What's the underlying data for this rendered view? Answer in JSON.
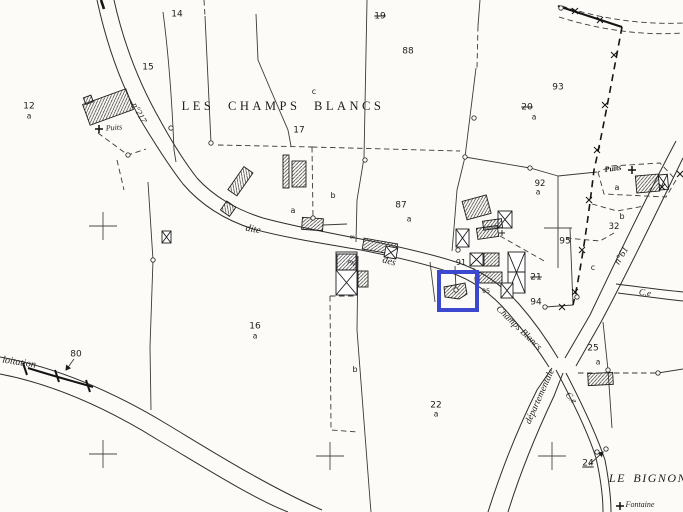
{
  "map": {
    "type": "cadastral-plan",
    "place_name_main": "LES CHAMPS BLANCS",
    "place_name_secondary": "LE BIGNON",
    "background": "#fcfbf7",
    "ink": "#222222",
    "highlight": {
      "x": 437,
      "y": 270,
      "w": 34,
      "h": 34,
      "color": "#3c49cf",
      "stroke": 4
    },
    "labels": [
      {
        "name": "place-les-champs-blancs",
        "t": "LES CHAMPS BLANCS",
        "x": 283,
        "y": 106,
        "fs": 12.5,
        "cls": "place",
        "ls": 3.5
      },
      {
        "name": "place-le-bignon",
        "t": "LE BIGNON",
        "x": 648,
        "y": 478,
        "fs": 12,
        "cls": "place italic",
        "ls": 1.5
      },
      {
        "name": "parcel-number-14",
        "t": "14",
        "x": 177,
        "y": 15,
        "fs": 9,
        "cls": "num"
      },
      {
        "name": "parcel-number-15",
        "t": "15",
        "x": 148,
        "y": 68,
        "fs": 9,
        "cls": "num"
      },
      {
        "name": "parcel-number-12",
        "t": "12",
        "x": 29,
        "y": 107,
        "fs": 9,
        "cls": "num"
      },
      {
        "name": "parcel-letter-12a",
        "t": "a",
        "x": 29,
        "y": 116,
        "fs": 7.5,
        "cls": "num"
      },
      {
        "name": "parcel-number-19-struck",
        "t": "19",
        "x": 380,
        "y": 17,
        "fs": 9,
        "cls": "num strike"
      },
      {
        "name": "parcel-number-88",
        "t": "88",
        "x": 408,
        "y": 52,
        "fs": 9,
        "cls": "num"
      },
      {
        "name": "parcel-number-93",
        "t": "93",
        "x": 558,
        "y": 88,
        "fs": 9,
        "cls": "num"
      },
      {
        "name": "parcel-number-20-struck",
        "t": "20",
        "x": 527,
        "y": 108,
        "fs": 9,
        "cls": "num strike"
      },
      {
        "name": "parcel-letter-20a",
        "t": "a",
        "x": 534,
        "y": 117,
        "fs": 7.5,
        "cls": "num"
      },
      {
        "name": "parcel-number-17",
        "t": "17",
        "x": 299,
        "y": 131,
        "fs": 9,
        "cls": "num"
      },
      {
        "name": "parcel-letter-c-top",
        "t": "c",
        "x": 314,
        "y": 92,
        "fs": 8,
        "cls": "num"
      },
      {
        "name": "parcel-number-87",
        "t": "87",
        "x": 401,
        "y": 206,
        "fs": 9,
        "cls": "num"
      },
      {
        "name": "parcel-letter-87a",
        "t": "a",
        "x": 409,
        "y": 219,
        "fs": 7.5,
        "cls": "num"
      },
      {
        "name": "parcel-letter-b-17",
        "t": "b",
        "x": 333,
        "y": 196,
        "fs": 8,
        "cls": "num"
      },
      {
        "name": "parcel-letter-a-17",
        "t": "a",
        "x": 293,
        "y": 211,
        "fs": 8,
        "cls": "num"
      },
      {
        "name": "parcel-number-92",
        "t": "92",
        "x": 540,
        "y": 184,
        "fs": 8.5,
        "cls": "num"
      },
      {
        "name": "parcel-letter-92a",
        "t": "a",
        "x": 538,
        "y": 192,
        "fs": 7.5,
        "cls": "num"
      },
      {
        "name": "parcel-number-95",
        "t": "95",
        "x": 565,
        "y": 242,
        "fs": 9,
        "cls": "num"
      },
      {
        "name": "parcel-number-91",
        "t": "91",
        "x": 461,
        "y": 263,
        "fs": 8,
        "cls": "num"
      },
      {
        "name": "parcel-number-21-struck",
        "t": "21",
        "x": 536,
        "y": 278,
        "fs": 9,
        "cls": "num strike"
      },
      {
        "name": "parcel-number-94",
        "t": "94",
        "x": 536,
        "y": 303,
        "fs": 9,
        "cls": "num"
      },
      {
        "name": "building-number-95-small",
        "t": "95",
        "x": 486,
        "y": 291,
        "fs": 6.5,
        "cls": "num"
      },
      {
        "name": "parcel-number-32",
        "t": "32",
        "x": 614,
        "y": 227,
        "fs": 8.5,
        "cls": "num"
      },
      {
        "name": "parcel-letter-a-right",
        "t": "a",
        "x": 617,
        "y": 188,
        "fs": 8,
        "cls": "num"
      },
      {
        "name": "parcel-letter-b-right",
        "t": "b",
        "x": 622,
        "y": 217,
        "fs": 8,
        "cls": "num"
      },
      {
        "name": "parcel-letter-c-right",
        "t": "c",
        "x": 593,
        "y": 268,
        "fs": 8,
        "cls": "num"
      },
      {
        "name": "parcel-number-16",
        "t": "16",
        "x": 255,
        "y": 327,
        "fs": 9,
        "cls": "num"
      },
      {
        "name": "parcel-letter-16a",
        "t": "a",
        "x": 255,
        "y": 336,
        "fs": 7.5,
        "cls": "num"
      },
      {
        "name": "parcel-letter-b-bottom",
        "t": "b",
        "x": 355,
        "y": 370,
        "fs": 8,
        "cls": "num"
      },
      {
        "name": "parcel-number-22",
        "t": "22",
        "x": 436,
        "y": 406,
        "fs": 9,
        "cls": "num"
      },
      {
        "name": "parcel-letter-22a",
        "t": "a",
        "x": 436,
        "y": 414,
        "fs": 7.5,
        "cls": "num"
      },
      {
        "name": "parcel-number-25",
        "t": "25",
        "x": 593,
        "y": 349,
        "fs": 9,
        "cls": "num"
      },
      {
        "name": "parcel-letter-25a",
        "t": "a",
        "x": 598,
        "y": 362,
        "fs": 7.5,
        "cls": "num"
      },
      {
        "name": "road-number-80",
        "t": "80",
        "x": 76,
        "y": 355,
        "fs": 9,
        "cls": "num"
      },
      {
        "name": "road-number-24",
        "t": "24",
        "x": 588,
        "y": 464,
        "fs": 9,
        "cls": "num under"
      },
      {
        "name": "tiny-mark-8",
        "t": "8",
        "x": 351,
        "y": 237,
        "fs": 6,
        "cls": "num",
        "rot": 90
      },
      {
        "name": "tiny-mark-pn",
        "t": "PN",
        "x": 351,
        "y": 264,
        "fs": 6,
        "cls": "num",
        "rot": 25
      },
      {
        "name": "road-label-n217",
        "t": "n°217",
        "x": 139,
        "y": 113,
        "fs": 9,
        "cls": "road",
        "rot": 62
      },
      {
        "name": "road-label-dite",
        "t": "dite",
        "x": 253,
        "y": 230,
        "fs": 10,
        "cls": "road",
        "rot": 10
      },
      {
        "name": "road-label-des",
        "t": "des",
        "x": 389,
        "y": 262,
        "fs": 10,
        "cls": "road",
        "rot": 16
      },
      {
        "name": "road-label-champs-blancs",
        "t": "Champs Blancs",
        "x": 518,
        "y": 329,
        "fs": 9.5,
        "cls": "road",
        "rot": 44
      },
      {
        "name": "road-label-departementale",
        "t": "départementale",
        "x": 541,
        "y": 397,
        "fs": 9.5,
        "cls": "road",
        "rot": -66
      },
      {
        "name": "road-label-n61",
        "t": "n°61",
        "x": 622,
        "y": 256,
        "fs": 10,
        "cls": "road",
        "rot": -59
      },
      {
        "name": "road-label-ce-right",
        "t": "C.e",
        "x": 645,
        "y": 293,
        "fs": 9,
        "cls": "road",
        "rot": 7
      },
      {
        "name": "road-label-ce-lower",
        "t": "C.e",
        "x": 571,
        "y": 398,
        "fs": 9,
        "cls": "road",
        "rot": 48
      },
      {
        "name": "road-label-exploitation",
        "t": "loitation",
        "x": 19,
        "y": 363,
        "fs": 10,
        "cls": "road",
        "rot": 9
      },
      {
        "name": "well-label-puits-left",
        "t": "Puits",
        "x": 114,
        "y": 128,
        "fs": 8,
        "cls": "road",
        "rot": -5
      },
      {
        "name": "well-label-puits-right",
        "t": "Puits",
        "x": 613,
        "y": 169,
        "fs": 8,
        "cls": "road bold",
        "rot": -8
      },
      {
        "name": "spring-label-fontaine",
        "t": "Fontaine",
        "x": 640,
        "y": 505,
        "fs": 8,
        "cls": "road"
      }
    ],
    "symbols": {
      "survey_crosses": [
        {
          "x": 103,
          "y": 226
        },
        {
          "x": 558,
          "y": 228
        },
        {
          "x": 103,
          "y": 454
        },
        {
          "x": 330,
          "y": 456
        },
        {
          "x": 552,
          "y": 456
        }
      ],
      "well_crosses": [
        {
          "x": 99,
          "y": 129
        },
        {
          "x": 632,
          "y": 170
        },
        {
          "x": 620,
          "y": 506
        }
      ],
      "x_marks": [
        {
          "x": 575,
          "y": 11
        },
        {
          "x": 600,
          "y": 20
        },
        {
          "x": 614,
          "y": 55
        },
        {
          "x": 605,
          "y": 105
        },
        {
          "x": 597,
          "y": 150
        },
        {
          "x": 589,
          "y": 200
        },
        {
          "x": 582,
          "y": 250
        },
        {
          "x": 575,
          "y": 292
        },
        {
          "x": 562,
          "y": 307
        },
        {
          "x": 662,
          "y": 187
        },
        {
          "x": 680,
          "y": 174
        }
      ],
      "junction_nodes": [
        {
          "x": 171,
          "y": 128
        },
        {
          "x": 211,
          "y": 143
        },
        {
          "x": 365,
          "y": 160
        },
        {
          "x": 458,
          "y": 250
        },
        {
          "x": 456,
          "y": 290
        },
        {
          "x": 474,
          "y": 118
        },
        {
          "x": 545,
          "y": 307
        },
        {
          "x": 577,
          "y": 297
        },
        {
          "x": 597,
          "y": 452
        },
        {
          "x": 606,
          "y": 449
        },
        {
          "x": 608,
          "y": 370
        },
        {
          "x": 658,
          "y": 373
        },
        {
          "x": 561,
          "y": 8
        },
        {
          "x": 465,
          "y": 157
        },
        {
          "x": 530,
          "y": 168
        },
        {
          "x": 153,
          "y": 260
        },
        {
          "x": 313,
          "y": 218
        },
        {
          "x": 128,
          "y": 155
        }
      ]
    }
  }
}
